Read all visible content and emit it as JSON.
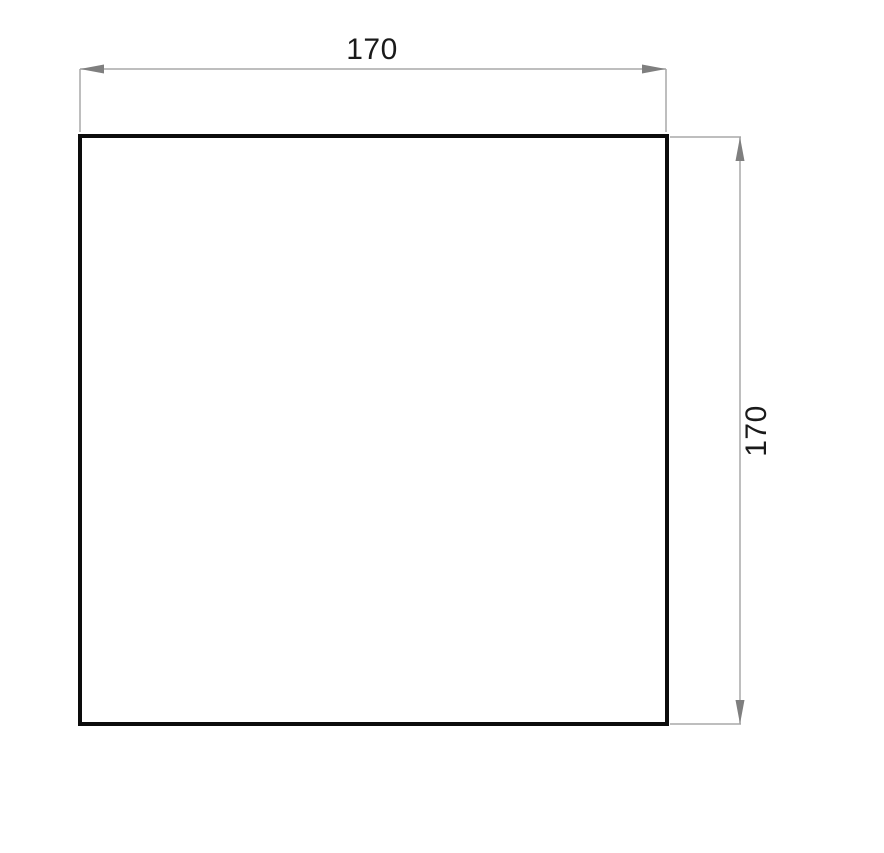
{
  "drawing": {
    "shape": "square",
    "dimensions": {
      "width": {
        "value": "170",
        "orientation": "horizontal",
        "position": "top"
      },
      "height": {
        "value": "170",
        "orientation": "vertical",
        "position": "right"
      }
    }
  },
  "colors": {
    "background": "#ffffff",
    "outline": "#0c0c0c",
    "dimension_line": "#a8a8a8",
    "arrowhead": "#7f7f7f",
    "label_text": "#1a1a1a"
  }
}
